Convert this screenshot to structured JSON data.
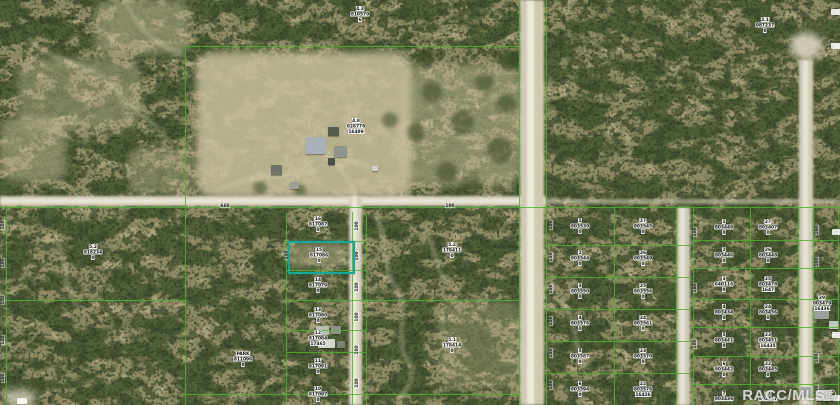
{
  "watermark": "RACC/MLS©",
  "colors": {
    "boundary_green": "#4cb32a",
    "highlight_teal": "#16a99b",
    "road_sand": "#e9e6d8",
    "label_background": "#ffffff",
    "watermark_white": "#fafafa"
  },
  "map": {
    "highlight": {
      "x": 288,
      "y": 241,
      "w": 63,
      "h": 29
    },
    "parcel_labels": [
      {
        "x": 360,
        "y": 14,
        "lines": [
          "4.3",
          "810570",
          "6"
        ]
      },
      {
        "x": 356,
        "y": 126,
        "lines": [
          "4.8",
          "828778",
          "16499"
        ]
      },
      {
        "x": 765,
        "y": 25,
        "lines": [
          "2.1",
          "987237",
          "0"
        ]
      },
      {
        "x": 93,
        "y": 252,
        "lines": [
          "5.2",
          "818234",
          "0"
        ]
      },
      {
        "x": 243,
        "y": 359,
        "lines": [
          "PARK",
          "811096",
          "0"
        ]
      },
      {
        "x": 318,
        "y": 224,
        "lines": [
          "16",
          "817087",
          "0"
        ]
      },
      {
        "x": 319,
        "y": 255,
        "lines": [
          "15",
          "817086",
          "0"
        ]
      },
      {
        "x": 318,
        "y": 285,
        "lines": [
          "14",
          "817079",
          "0"
        ]
      },
      {
        "x": 318,
        "y": 315,
        "lines": [
          "13",
          "817080",
          "0"
        ]
      },
      {
        "x": 318,
        "y": 338,
        "lines": [
          "12",
          "817084",
          "17465"
        ]
      },
      {
        "x": 318,
        "y": 366,
        "lines": [
          "11",
          "817091",
          "0"
        ]
      },
      {
        "x": 318,
        "y": 394,
        "lines": [
          "10",
          "817097",
          "0"
        ]
      },
      {
        "x": 452,
        "y": 250,
        "lines": [
          "5.2",
          "178411",
          "0"
        ]
      },
      {
        "x": 452,
        "y": 345,
        "lines": [
          "5.1",
          "178414",
          "0"
        ]
      },
      {
        "x": 580,
        "y": 226,
        "lines": [
          "1",
          "803530",
          "0"
        ]
      },
      {
        "x": 580,
        "y": 258,
        "lines": [
          "2",
          "803544",
          "0"
        ]
      },
      {
        "x": 580,
        "y": 291,
        "lines": [
          "3",
          "803550",
          "0"
        ]
      },
      {
        "x": 580,
        "y": 323,
        "lines": [
          "4",
          "803576",
          "0"
        ]
      },
      {
        "x": 580,
        "y": 356,
        "lines": [
          "5",
          "803587",
          "0"
        ]
      },
      {
        "x": 580,
        "y": 389,
        "lines": [
          "6",
          "803594",
          "0"
        ]
      },
      {
        "x": 643,
        "y": 226,
        "lines": [
          "27",
          "803545",
          "0"
        ]
      },
      {
        "x": 643,
        "y": 258,
        "lines": [
          "26",
          "803549",
          "0"
        ]
      },
      {
        "x": 643,
        "y": 291,
        "lines": [
          "25",
          "803556",
          "0"
        ]
      },
      {
        "x": 643,
        "y": 323,
        "lines": [
          "24",
          "803561",
          "0"
        ]
      },
      {
        "x": 643,
        "y": 356,
        "lines": [
          "23",
          "803570",
          "0"
        ]
      },
      {
        "x": 643,
        "y": 389,
        "lines": [
          "22",
          "803576",
          "16426"
        ]
      },
      {
        "x": 724,
        "y": 227,
        "lines": [
          "1",
          "803448",
          "0"
        ]
      },
      {
        "x": 724,
        "y": 255,
        "lines": [
          "2",
          "803446",
          "0"
        ]
      },
      {
        "x": 724,
        "y": 284,
        "lines": [
          "3",
          "640116",
          "0"
        ]
      },
      {
        "x": 724,
        "y": 312,
        "lines": [
          "4",
          "803434",
          "0"
        ]
      },
      {
        "x": 724,
        "y": 340,
        "lines": [
          "5",
          "803441",
          "0"
        ]
      },
      {
        "x": 724,
        "y": 369,
        "lines": [
          "6",
          "803442",
          "0"
        ]
      },
      {
        "x": 724,
        "y": 396,
        "lines": [
          "7",
          "803436"
        ]
      },
      {
        "x": 768,
        "y": 227,
        "lines": [
          "27",
          "803407",
          "0"
        ]
      },
      {
        "x": 768,
        "y": 255,
        "lines": [
          "26",
          "803448",
          "0"
        ]
      },
      {
        "x": 768,
        "y": 284,
        "lines": [
          "25",
          "803478",
          "1647"
        ]
      },
      {
        "x": 768,
        "y": 312,
        "lines": [
          "24",
          "803456",
          "0"
        ]
      },
      {
        "x": 768,
        "y": 340,
        "lines": [
          "23",
          "803451",
          "16435"
        ]
      },
      {
        "x": 768,
        "y": 369,
        "lines": [
          "22",
          "803445",
          "0"
        ]
      },
      {
        "x": 768,
        "y": 396,
        "lines": [
          "21",
          "803447"
        ]
      },
      {
        "x": 822,
        "y": 303,
        "lines": [
          "29",
          "803479",
          "16436"
        ]
      }
    ],
    "ticks": [
      {
        "x": 3,
        "y": 225,
        "t": "100",
        "r": 1
      },
      {
        "x": 3,
        "y": 263,
        "t": "100",
        "r": 1
      },
      {
        "x": 3,
        "y": 300,
        "t": "100",
        "r": 1
      },
      {
        "x": 3,
        "y": 340,
        "t": "100",
        "r": 1
      },
      {
        "x": 3,
        "y": 378,
        "t": "100",
        "r": 1
      },
      {
        "x": 287,
        "y": 255,
        "t": "100",
        "r": 1
      },
      {
        "x": 357,
        "y": 226,
        "t": "100",
        "r": 1
      },
      {
        "x": 357,
        "y": 256,
        "t": "100",
        "r": 1
      },
      {
        "x": 357,
        "y": 287,
        "t": "100",
        "r": 1
      },
      {
        "x": 357,
        "y": 317,
        "t": "100",
        "r": 1
      },
      {
        "x": 357,
        "y": 350,
        "t": "100",
        "r": 1
      },
      {
        "x": 357,
        "y": 383,
        "t": "100",
        "r": 1
      },
      {
        "x": 551,
        "y": 225,
        "t": "100",
        "r": 1
      },
      {
        "x": 551,
        "y": 257,
        "t": "100",
        "r": 1
      },
      {
        "x": 551,
        "y": 289,
        "t": "100",
        "r": 1
      },
      {
        "x": 551,
        "y": 321,
        "t": "100",
        "r": 1
      },
      {
        "x": 551,
        "y": 353,
        "t": "100",
        "r": 1
      },
      {
        "x": 551,
        "y": 385,
        "t": "100",
        "r": 1
      },
      {
        "x": 695,
        "y": 232,
        "t": "100",
        "r": 1
      },
      {
        "x": 695,
        "y": 288,
        "t": "100",
        "r": 1
      },
      {
        "x": 695,
        "y": 344,
        "t": "100",
        "r": 1
      },
      {
        "x": 817,
        "y": 230,
        "t": "100",
        "r": 1
      },
      {
        "x": 817,
        "y": 262,
        "t": "100",
        "r": 1
      },
      {
        "x": 817,
        "y": 358,
        "t": "100",
        "r": 1
      },
      {
        "x": 817,
        "y": 390,
        "t": "100",
        "r": 1
      },
      {
        "x": 225,
        "y": 206,
        "t": "660",
        "r": 0
      },
      {
        "x": 450,
        "y": 206,
        "t": "100",
        "r": 0
      }
    ],
    "edge_chips": [
      {
        "x": 836,
        "y": 12
      },
      {
        "x": 836,
        "y": 46
      },
      {
        "x": 837,
        "y": 232
      },
      {
        "x": 837,
        "y": 335
      },
      {
        "x": 22,
        "y": 401
      },
      {
        "x": 837,
        "y": 398
      }
    ],
    "green_lines": {
      "v": [
        [
          6,
          208,
          405
        ],
        [
          185,
          46,
          405
        ],
        [
          286,
          212,
          405
        ],
        [
          352,
          212,
          405
        ],
        [
          366,
          212,
          405
        ],
        [
          519,
          0,
          405
        ],
        [
          546,
          0,
          405
        ],
        [
          614,
          208,
          405
        ],
        [
          676,
          208,
          405
        ],
        [
          693,
          208,
          405
        ],
        [
          750,
          208,
          405
        ],
        [
          798,
          208,
          405
        ],
        [
          813,
          208,
          405
        ],
        [
          838,
          208,
          405
        ]
      ],
      "h": [
        [
          46,
          185,
          519
        ],
        [
          207,
          0,
          840
        ],
        [
          241,
          286,
          366
        ],
        [
          270,
          286,
          366
        ],
        [
          300,
          0,
          187
        ],
        [
          300,
          286,
          519
        ],
        [
          330,
          286,
          366
        ],
        [
          352,
          286,
          366
        ],
        [
          394,
          185,
          519
        ],
        [
          245,
          546,
          691
        ],
        [
          277,
          546,
          691
        ],
        [
          309,
          546,
          691
        ],
        [
          341,
          546,
          691
        ],
        [
          373,
          546,
          691
        ],
        [
          240,
          693,
          838
        ],
        [
          268,
          693,
          838
        ],
        [
          299,
          693,
          838
        ],
        [
          327,
          693,
          838
        ],
        [
          356,
          693,
          838
        ],
        [
          384,
          693,
          838
        ]
      ]
    },
    "buildings": [
      {
        "x": 306,
        "y": 137,
        "w": 20,
        "h": 17,
        "c": "#a9b1b8"
      },
      {
        "x": 328,
        "y": 127,
        "w": 11,
        "h": 9,
        "c": "#565b50"
      },
      {
        "x": 334,
        "y": 146,
        "w": 13,
        "h": 11,
        "c": "#8f948c"
      },
      {
        "x": 328,
        "y": 158,
        "w": 7,
        "h": 7,
        "c": "#4c5046"
      },
      {
        "x": 271,
        "y": 165,
        "w": 11,
        "h": 10,
        "c": "#6f7467"
      },
      {
        "x": 290,
        "y": 182,
        "w": 9,
        "h": 7,
        "c": "#9aa096"
      },
      {
        "x": 372,
        "y": 166,
        "w": 6,
        "h": 5,
        "c": "#cfd2cc"
      },
      {
        "x": 316,
        "y": 326,
        "w": 13,
        "h": 9,
        "c": "#b9bdb7"
      },
      {
        "x": 331,
        "y": 326,
        "w": 10,
        "h": 8,
        "c": "#8d928a"
      },
      {
        "x": 318,
        "y": 339,
        "w": 17,
        "h": 9,
        "c": "#d6d8d0"
      },
      {
        "x": 337,
        "y": 341,
        "w": 8,
        "h": 7,
        "c": "#7d8278"
      },
      {
        "x": 814,
        "y": 308,
        "w": 15,
        "h": 11,
        "c": "#9aa09b"
      },
      {
        "x": 829,
        "y": 321,
        "w": 10,
        "h": 8,
        "c": "#c2c6be"
      },
      {
        "x": 799,
        "y": 387,
        "w": 12,
        "h": 9,
        "c": "#a9aea6"
      },
      {
        "x": 816,
        "y": 390,
        "w": 16,
        "h": 11,
        "c": "#d8dad2"
      }
    ]
  }
}
